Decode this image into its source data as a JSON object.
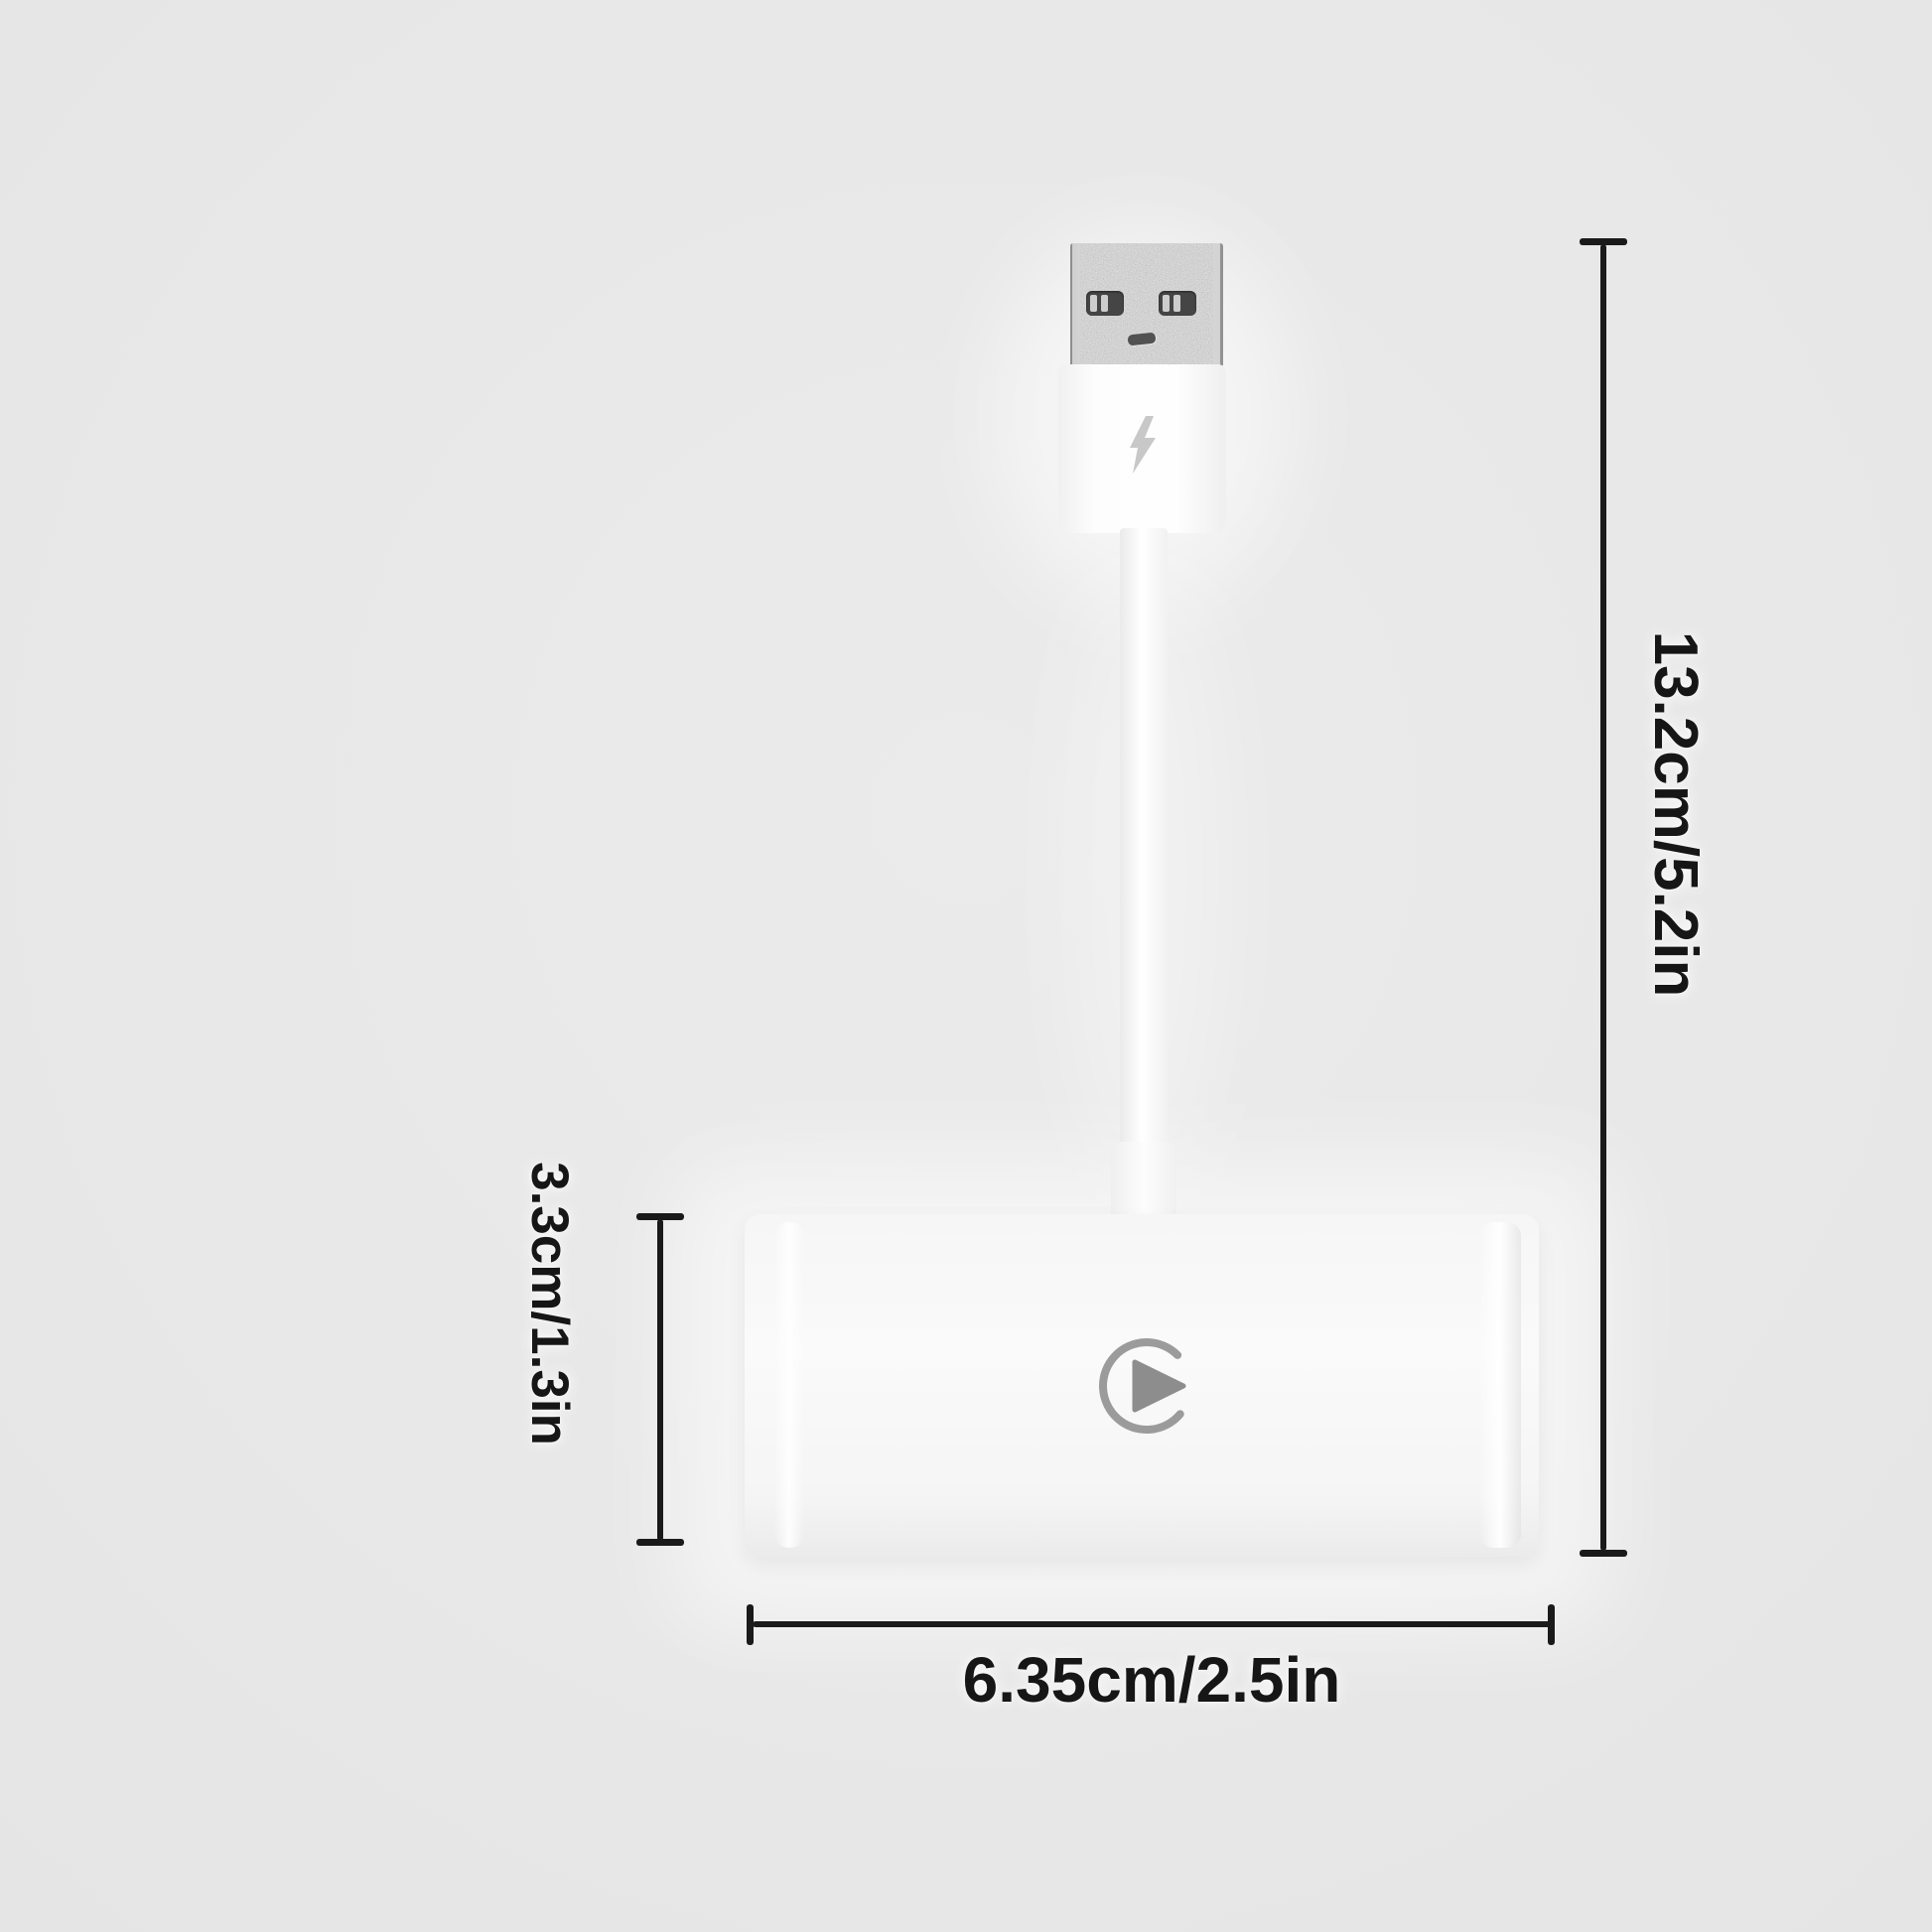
{
  "page": {
    "type": "product-dimension-diagram",
    "background_color": "#e8e8e8"
  },
  "product": {
    "usb_plug": {
      "icon": "lightning-bolt-icon"
    },
    "adapter_box": {
      "icon": "play-icon"
    }
  },
  "dimensions": {
    "total_height": {
      "label": "13.2cm/5.2in"
    },
    "box_height": {
      "label": "3.3cm/1.3in"
    },
    "box_width": {
      "label": "6.35cm/2.5in"
    }
  },
  "colors": {
    "dimension_line": "#1a1a1a",
    "label_text": "#161616",
    "metal": "#a2a2a2",
    "plastic_white": "#fafafa",
    "icon_gray": "#9b9b9b"
  }
}
